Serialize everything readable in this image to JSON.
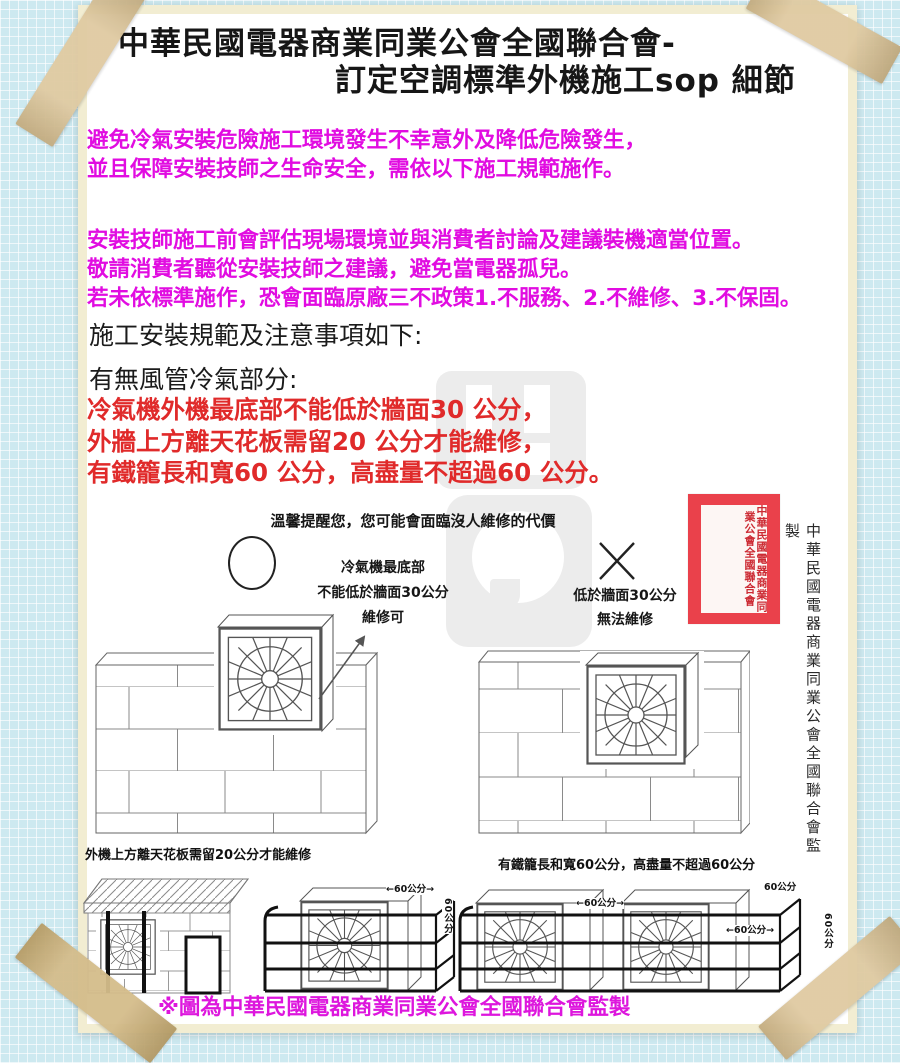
{
  "title": {
    "line1": "中華民國電器商業同業公會全國聯合會-",
    "line2": "訂定空調標準外機施工sop 細節"
  },
  "intro": {
    "lines": [
      "避免冷氣安裝危險施工環境發生不幸意外及降低危險發生，",
      "並且保障安裝技師之生命安全，需依以下施工規範施作。"
    ]
  },
  "notice": {
    "lines": [
      "安裝技師施工前會評估現場環境並與消費者討論及建議裝機適當位置。",
      "敬請消費者聽從安裝技師之建議，避免當電器孤兒。",
      "若未依標準施作，恐會面臨原廠三不政策1.不服務、2.不維修、3.不保固。"
    ]
  },
  "headings": {
    "spec": "施工安裝規範及注意事項如下:",
    "section": "有無風管冷氣部分:"
  },
  "rules": {
    "lines": [
      "冷氣機外機最底部不能低於牆面30 公分，",
      "外牆上方離天花板需留20 公分才能維修，",
      "有鐵籠長和寬60 公分，高盡量不超過60 公分。"
    ]
  },
  "figure": {
    "reminder": "溫馨提醒您，您可能會面臨沒人維修的代價",
    "ok_lines": [
      "冷氣機最底部",
      "不能低於牆面30公分",
      "維修可"
    ],
    "bad_lines": [
      "低於牆面30公分",
      "無法維修"
    ],
    "caption_left": "外機上方離天花板需留20公分才能維修",
    "caption_right": "有鐵籠長和寬60公分，高盡量不超過60公分",
    "dims": {
      "between": "←60公分→",
      "plain": "60公分",
      "vertical": "60公分"
    }
  },
  "stamp": {
    "text": "中華民國電器商業同業公會全國聯合會"
  },
  "side_note": "中華民國電器商業同業公會全國聯合會監製",
  "footer": "※圖為中華民國電器商業同業公會全國聯合會監製",
  "colors": {
    "magenta": "#e10ce1",
    "red": "#e02a2a",
    "stamp_red": "#ea414b",
    "paper_trim": "#f2edd2",
    "tape": "#d9bf8e",
    "background": "#cde9f0"
  }
}
